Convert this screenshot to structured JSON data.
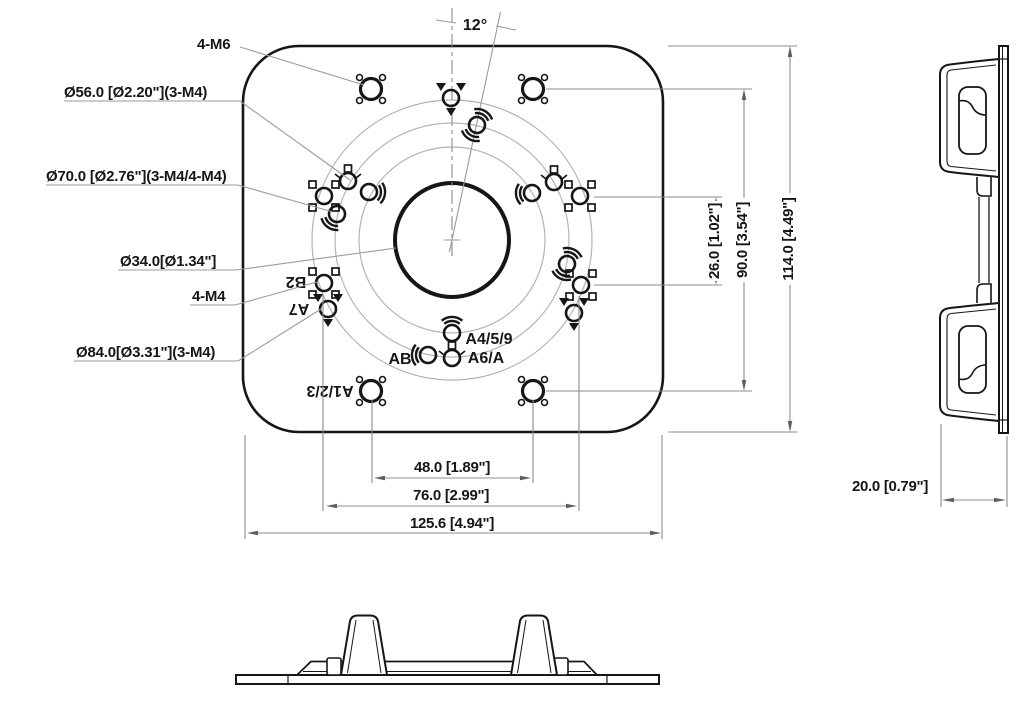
{
  "colors": {
    "ink": "#161616",
    "construction": "#9b9b9b"
  },
  "front": {
    "angle_label": "12°",
    "callouts": {
      "m6": "4-M6",
      "d56": "Ø56.0 [Ø2.20\"](3-M4)",
      "d70": "Ø70.0 [Ø2.76\"](3-M4/4-M4)",
      "d34": "Ø34.0[Ø1.34\"]",
      "m4": "4-M4",
      "d84": "Ø84.0[Ø3.31\"](3-M4)"
    },
    "ports": {
      "b2": "B2",
      "a7": "A7",
      "a123": "A1/2/3",
      "ab": "AB",
      "a459": "A4/5/9",
      "a6a": "A6/A"
    },
    "dims": {
      "v26": "26.0 [1.02\"]",
      "v90": "90.0 [3.54\"]",
      "v114": "114.0 [4.49\"]",
      "w48": "48.0 [1.89\"]",
      "w76": "76.0 [2.99\"]",
      "w126": "125.6 [4.94\"]"
    }
  },
  "side": {
    "dims": {
      "d20": "20.0 [0.79\"]"
    }
  }
}
